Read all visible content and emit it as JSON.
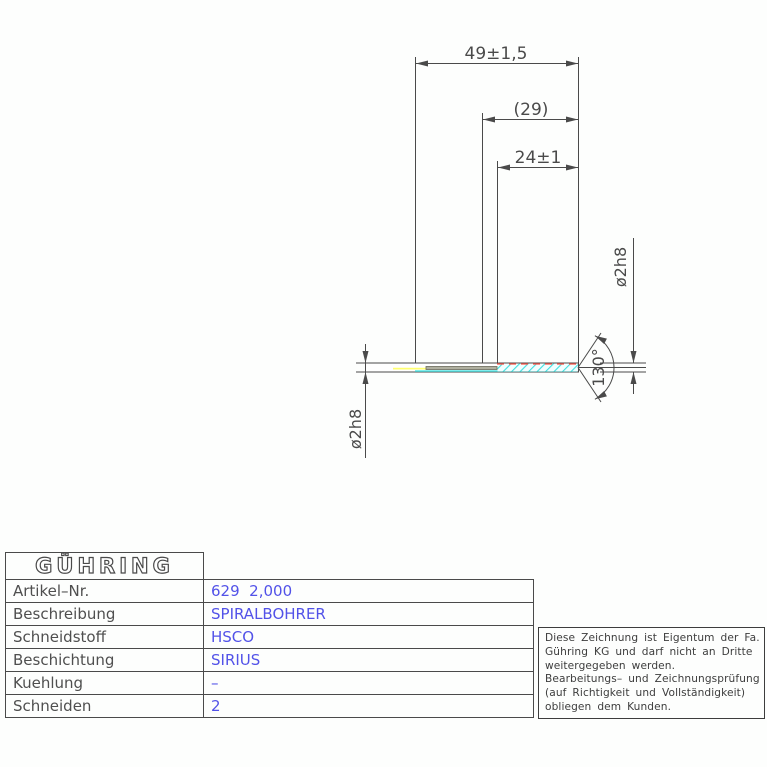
{
  "drawing": {
    "dim_total_length": "49±1,5",
    "dim_ref_length": "(29)",
    "dim_flute_length": "24±1",
    "dim_point_angle": "130°",
    "dim_diameter_tip": "ø2h8",
    "dim_diameter_shank": "ø2h8"
  },
  "table": {
    "logo": "GÜHRING",
    "rows": [
      {
        "label": "Artikel–Nr.",
        "value": "629  2,000"
      },
      {
        "label": "Beschreibung",
        "value": "SPIRALBOHRER"
      },
      {
        "label": "Schneidstoff",
        "value": "HSCO"
      },
      {
        "label": "Beschichtung",
        "value": "SIRIUS"
      },
      {
        "label": "Kuehlung",
        "value": "–"
      },
      {
        "label": "Schneiden",
        "value": "2"
      }
    ]
  },
  "notice": {
    "lines": [
      "Diese Zeichnung ist Eigentum der Fa.",
      "Gühring KG und darf nicht an Dritte",
      "weitergegeben werden.",
      "Bearbeitungs– und Zeichnungsprüfung",
      "(auf Richtigkeit und Vollständigkeit)",
      "obliegen dem Kunden."
    ]
  },
  "colors": {
    "line": "#4a4a4a",
    "value_blue": "#5252e8",
    "flute_cyan": "#3fe0e0",
    "highlight_yellow": "#ffff70",
    "edge_red": "#ff5548",
    "core_gray": "#b0b0a0"
  }
}
